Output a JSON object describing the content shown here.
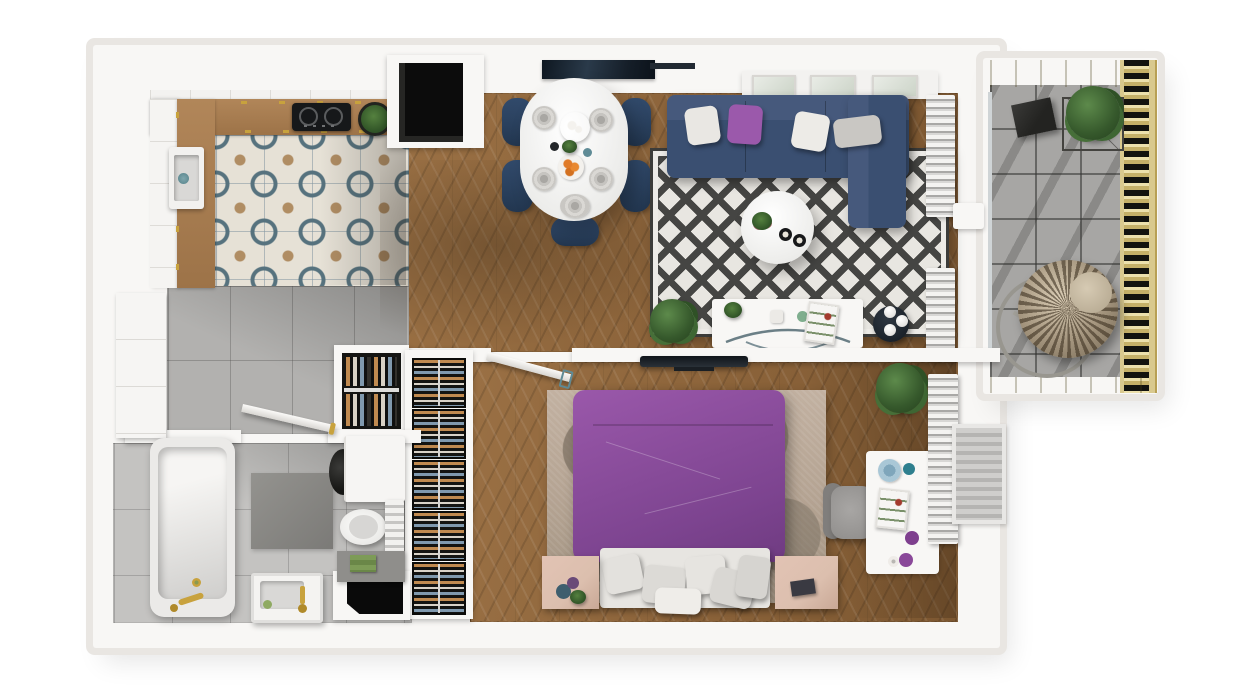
{
  "meta": {
    "kind": "3d-apartment-floor-plan-render",
    "view": "top-down",
    "width_px": 1244,
    "height_px": 700,
    "visible_text": "none"
  },
  "palette": {
    "bg": "#ffffff",
    "wall": "#f8f7f5",
    "wall-shadow": "#e9e6e2",
    "wood": "#9a7044",
    "tile-base": "#e6e1d6",
    "tile-blue": "#56727e",
    "tile-tan": "#b08d63",
    "gray-tile": "#b2b1af",
    "bath-tile": "#c4c3c1",
    "balcony-tile": "#a7a6a4",
    "deck-gold": "#cdb97c",
    "navy": "#3c5375",
    "chair-navy": "#2f4767",
    "purple": "#8d4f9e",
    "pillow-purple": "#9b59ab",
    "rug-dark": "#454543",
    "rug-light": "#e8e6e1",
    "bedroom-rug": "#b3a291",
    "nightstand-wood": "#dcbfae",
    "gold": "#c8a23d",
    "plant-green": "#3e6633",
    "teal": "#2e7f8e",
    "clothes-tan": "#c08a50",
    "clothes-blue": "#8099ae"
  },
  "rooms": [
    {
      "name": "Kitchen",
      "floor": "patterned cement tile",
      "items": [
        "white L-shaped cabinets with oak counter",
        "induction cooktop",
        "sink with brass tap",
        "potted herb",
        "ventilation shaft"
      ]
    },
    {
      "name": "Dining area",
      "floor": "chevron oak parquet",
      "items": [
        "white oval table",
        "5 navy dining chairs",
        "4 gray place settings",
        "gold tray",
        "bowl of oranges",
        "dark glass wall panel"
      ]
    },
    {
      "name": "Living room",
      "floor": "chevron oak parquet",
      "items": [
        "navy corner sofa",
        "2 white pillows",
        "1 purple pillow",
        "1 gray pillow",
        "black and white diamond rug",
        "round white coffee table",
        "flowers and candles",
        "white TV sideboard with curved glass base",
        "floor plant",
        "black side table with 3 white spheres",
        "wall console with 3 frames",
        "vertical blinds"
      ]
    },
    {
      "name": "Balcony",
      "floor": "gray stone tile",
      "items": [
        "timber pergola edge",
        "timber slat railing",
        "rattan hanging egg chair",
        "wire frame planter with tree",
        "black folding side table"
      ]
    },
    {
      "name": "Hallway",
      "floor": "gray ceramic tile",
      "items": [
        "open closet with hanging clothes",
        "tall five bay wardrobe",
        "dark entrance recess"
      ]
    },
    {
      "name": "Bathroom",
      "floor": "light gray tile",
      "items": [
        "bathtub with brass fittings",
        "washing machine",
        "toilet",
        "towel radiator",
        "vanity sink with brass tap",
        "dark gray bath mat",
        "tall white cabinet",
        "green towels on shelf",
        "open door"
      ]
    },
    {
      "name": "Bedroom",
      "floor": "chevron oak parquet",
      "items": [
        "double bed with purple duvet",
        "6 light pillows",
        "mottled beige rug",
        "2 light wood nightstands",
        "white desk with accessories",
        "gray office chair",
        "wall mounted TV",
        "potted plant",
        "vertical blinds",
        "window"
      ]
    }
  ],
  "counts": {
    "rooms": 7,
    "dining_chairs": 5,
    "sofa_pillows": 4,
    "bed_pillows": 6,
    "wardrobe_bays": 5
  }
}
